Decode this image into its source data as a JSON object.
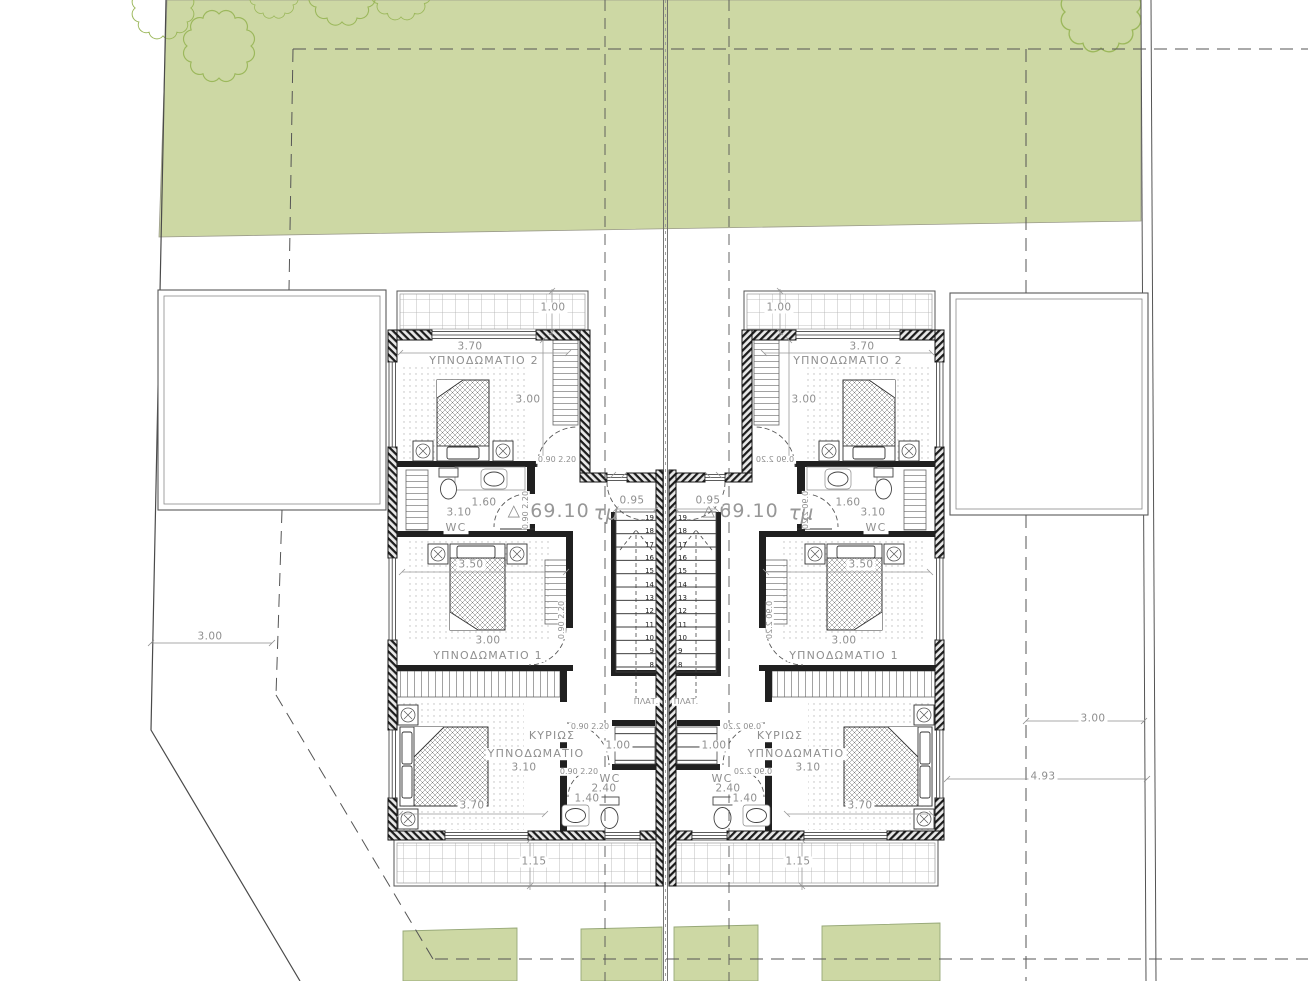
{
  "colors": {
    "garden_fill": "#cdd8a4",
    "tree_stroke": "#9cb85c",
    "wall": "#1a1a1a",
    "line": "#555555",
    "dim_text": "#8f8f8f"
  },
  "stairs": {
    "numbers": [
      "19",
      "18",
      "17",
      "16",
      "15",
      "14",
      "13",
      "12",
      "11",
      "10",
      "9",
      "8"
    ],
    "top": 512,
    "columns": [
      {
        "name": "left-stair-numbers",
        "left": 637,
        "width": 17,
        "align": "right"
      },
      {
        "name": "right-stair-numbers",
        "left": 678,
        "width": 17,
        "align": "left"
      }
    ]
  },
  "labels": [
    {
      "name": "site-dim-left-setback",
      "text": "3.00",
      "x": 210,
      "y": 637,
      "cls": "wbg"
    },
    {
      "name": "site-dim-right-setback",
      "text": "3.00",
      "x": 1093,
      "y": 719,
      "cls": "wbg"
    },
    {
      "name": "site-dim-right-offset",
      "text": "4.93",
      "x": 1043,
      "y": 777,
      "cls": "wbg"
    },
    {
      "name": "left-balcony-top-dim",
      "text": "1.00",
      "x": 553,
      "y": 308,
      "cls": "wbg"
    },
    {
      "name": "left-bed2-width-dim",
      "text": "3.70",
      "x": 470,
      "y": 347,
      "cls": "wbg"
    },
    {
      "name": "left-bed2-name",
      "text": "ΥΠΝΟΔΩΜΑΤΙΟ 2",
      "x": 484,
      "y": 361,
      "cls": "room wbg"
    },
    {
      "name": "left-bed2-depth-dim",
      "text": "3.00",
      "x": 528,
      "y": 400,
      "cls": "wbg"
    },
    {
      "name": "left-bed2-door-dim",
      "text": "0.90 2.20",
      "x": 557,
      "y": 460,
      "cls": "sm wbg"
    },
    {
      "name": "left-wc1-door-dim",
      "text": "0.90 2.20",
      "x": 526,
      "y": 510,
      "cls": "sm vert"
    },
    {
      "name": "left-wc1-width-dim",
      "text": "1.60",
      "x": 484,
      "y": 503,
      "cls": "wbg"
    },
    {
      "name": "left-wc1-length-dim",
      "text": "3.10",
      "x": 459,
      "y": 513,
      "cls": "wbg"
    },
    {
      "name": "left-wc1-name",
      "text": "WC",
      "x": 456,
      "y": 528,
      "cls": "room wbg"
    },
    {
      "name": "left-area-triangle",
      "text": "△",
      "x": 514,
      "y": 511,
      "cls": "tri"
    },
    {
      "name": "left-area-value",
      "text": "69.10",
      "x": 560,
      "y": 512,
      "cls": "big"
    },
    {
      "name": "left-area-unit",
      "text": "τμ",
      "x": 606,
      "y": 513,
      "cls": "big italic"
    },
    {
      "name": "left-stair-width-dim",
      "text": "0.95",
      "x": 632,
      "y": 501,
      "cls": "wbg"
    },
    {
      "name": "left-landing-label",
      "text": "ΠΛΑΤ.",
      "x": 646,
      "y": 702,
      "cls": "sm wbg"
    },
    {
      "name": "left-bed1-width-dim",
      "text": "3.50",
      "x": 471,
      "y": 565,
      "cls": "wbg"
    },
    {
      "name": "left-bed1-door-dim",
      "text": "0.90 2.20",
      "x": 562,
      "y": 620,
      "cls": "sm vert"
    },
    {
      "name": "left-bed1-depth-dim",
      "text": "3.00",
      "x": 488,
      "y": 641,
      "cls": "wbg"
    },
    {
      "name": "left-bed1-name",
      "text": "ΥΠΝΟΔΩΜΑΤΙΟ 1",
      "x": 488,
      "y": 656,
      "cls": "room wbg"
    },
    {
      "name": "left-master-name-line1",
      "text": "ΚΥΡΙΩΣ",
      "x": 552,
      "y": 736,
      "cls": "room wbg"
    },
    {
      "name": "left-master-name-line2",
      "text": "ΥΠΝΟΔΩΜΑΤΙΟ",
      "x": 536,
      "y": 754,
      "cls": "room wbg"
    },
    {
      "name": "left-master-depth-dim",
      "text": "3.10",
      "x": 524,
      "y": 768,
      "cls": "wbg"
    },
    {
      "name": "left-hall-width-dim",
      "text": "1.00",
      "x": 618,
      "y": 746,
      "cls": "wbg"
    },
    {
      "name": "left-master-door-dim",
      "text": "0.90 2.20",
      "x": 590,
      "y": 727,
      "cls": "sm wbg"
    },
    {
      "name": "left-wc2-door-dim",
      "text": "0.90 2.20",
      "x": 579,
      "y": 772,
      "cls": "sm wbg"
    },
    {
      "name": "left-wc2-name",
      "text": "WC",
      "x": 610,
      "y": 779,
      "cls": "room wbg"
    },
    {
      "name": "left-wc2-length-dim",
      "text": "2.40",
      "x": 604,
      "y": 789,
      "cls": "wbg"
    },
    {
      "name": "left-wc2-width-dim",
      "text": "1.40",
      "x": 587,
      "y": 799,
      "cls": "wbg"
    },
    {
      "name": "left-master-width-dim",
      "text": "3.70",
      "x": 472,
      "y": 806,
      "cls": "wbg"
    },
    {
      "name": "left-balcony-bottom-dim",
      "text": "1.15",
      "x": 534,
      "y": 862,
      "cls": "wbg"
    },
    {
      "name": "right-balcony-top-dim",
      "text": "1.00",
      "x": 779,
      "y": 308,
      "cls": "wbg"
    },
    {
      "name": "right-bed2-width-dim",
      "text": "3.70",
      "x": 862,
      "y": 347,
      "cls": "wbg"
    },
    {
      "name": "right-bed2-name",
      "text": "ΥΠΝΟΔΩΜΑΤΙΟ 2",
      "x": 848,
      "y": 361,
      "cls": "room wbg"
    },
    {
      "name": "right-bed2-depth-dim",
      "text": "3.00",
      "x": 804,
      "y": 400,
      "cls": "wbg"
    },
    {
      "name": "right-bed2-door-dim",
      "text": "0.90 2.20",
      "x": 775,
      "y": 460,
      "cls": "sm wbg mir"
    },
    {
      "name": "right-wc1-door-dim",
      "text": "0.90 2.20",
      "x": 806,
      "y": 510,
      "cls": "sm vertmir"
    },
    {
      "name": "right-wc1-width-dim",
      "text": "1.60",
      "x": 848,
      "y": 503,
      "cls": "wbg"
    },
    {
      "name": "right-wc1-length-dim",
      "text": "3.10",
      "x": 873,
      "y": 513,
      "cls": "wbg"
    },
    {
      "name": "right-wc1-name",
      "text": "WC",
      "x": 876,
      "y": 528,
      "cls": "room wbg"
    },
    {
      "name": "right-area-triangle",
      "text": "△",
      "x": 709,
      "y": 511,
      "cls": "tri"
    },
    {
      "name": "right-area-value",
      "text": "69.10",
      "x": 749,
      "y": 512,
      "cls": "big"
    },
    {
      "name": "right-area-unit",
      "text": "τμ",
      "x": 801,
      "y": 513,
      "cls": "big italic"
    },
    {
      "name": "right-stair-width-dim",
      "text": "0.95",
      "x": 708,
      "y": 501,
      "cls": "wbg"
    },
    {
      "name": "right-landing-label",
      "text": "ΠΛΑΤ.",
      "x": 686,
      "y": 702,
      "cls": "sm wbg"
    },
    {
      "name": "right-bed1-width-dim",
      "text": "3.50",
      "x": 861,
      "y": 565,
      "cls": "wbg"
    },
    {
      "name": "right-bed1-door-dim",
      "text": "0.90 2.20",
      "x": 770,
      "y": 620,
      "cls": "sm vertmir"
    },
    {
      "name": "right-bed1-depth-dim",
      "text": "3.00",
      "x": 844,
      "y": 641,
      "cls": "wbg"
    },
    {
      "name": "right-bed1-name",
      "text": "ΥΠΝΟΔΩΜΑΤΙΟ 1",
      "x": 844,
      "y": 656,
      "cls": "room wbg"
    },
    {
      "name": "right-master-name-line1",
      "text": "ΚΥΡΙΩΣ",
      "x": 780,
      "y": 736,
      "cls": "room wbg"
    },
    {
      "name": "right-master-name-line2",
      "text": "ΥΠΝΟΔΩΜΑΤΙΟ",
      "x": 796,
      "y": 754,
      "cls": "room wbg"
    },
    {
      "name": "right-master-depth-dim",
      "text": "3.10",
      "x": 808,
      "y": 768,
      "cls": "wbg"
    },
    {
      "name": "right-hall-width-dim",
      "text": "1.00",
      "x": 714,
      "y": 746,
      "cls": "wbg"
    },
    {
      "name": "right-master-door-dim",
      "text": "0.90 2.20",
      "x": 742,
      "y": 727,
      "cls": "sm wbg mir"
    },
    {
      "name": "right-wc2-door-dim",
      "text": "0.90 2.20",
      "x": 753,
      "y": 772,
      "cls": "sm wbg mir"
    },
    {
      "name": "right-wc2-name",
      "text": "WC",
      "x": 722,
      "y": 779,
      "cls": "room wbg"
    },
    {
      "name": "right-wc2-length-dim",
      "text": "2.40",
      "x": 728,
      "y": 789,
      "cls": "wbg"
    },
    {
      "name": "right-wc2-width-dim",
      "text": "1.40",
      "x": 745,
      "y": 799,
      "cls": "wbg"
    },
    {
      "name": "right-master-width-dim",
      "text": "3.70",
      "x": 860,
      "y": 806,
      "cls": "wbg"
    },
    {
      "name": "right-balcony-bottom-dim",
      "text": "1.15",
      "x": 798,
      "y": 862,
      "cls": "wbg"
    }
  ]
}
